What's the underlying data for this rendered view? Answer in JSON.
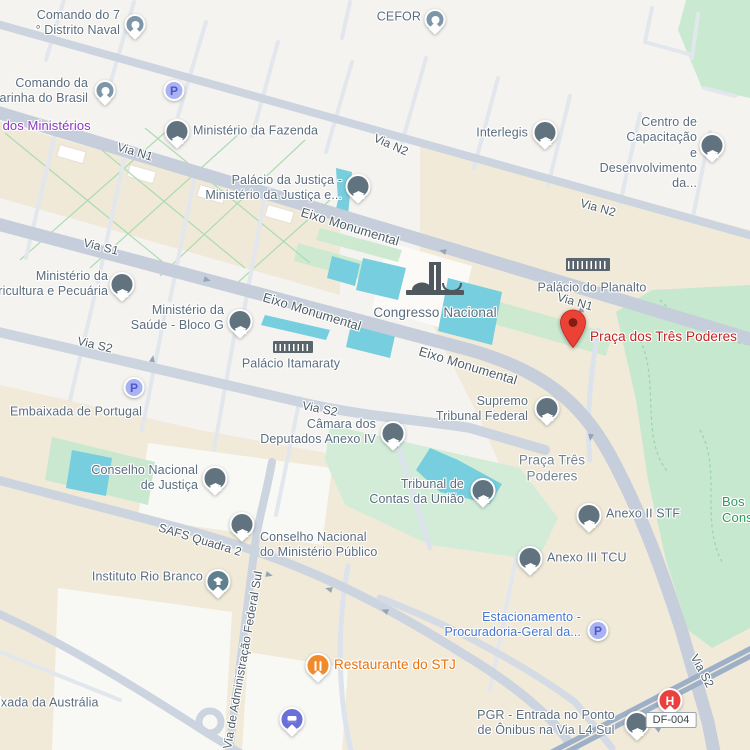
{
  "app": "google-maps-view",
  "locale_region": "Brasília, DF, Brasil",
  "labels": {
    "comando_distrito_naval": "Comando do 7\n° Distrito Naval",
    "cefor": "CEFOR",
    "comando_marinha": "Comando da\nMarinha do Brasil",
    "via_dos_ministerios": "Via dos Ministérios",
    "ministerio_fazenda": "Ministério da Fazenda",
    "via_n1": "Via N1",
    "via_n2": "Via N2",
    "interlegis": "Interlegis",
    "centro_capacitacao": "Centro de Capacitação\ne Desenvolvimento da...",
    "palacio_justica": "Palácio da Justiça -\nMinistério da Justiça e...",
    "eixo_monumental": "Eixo Monumental",
    "via_s1": "Via S1",
    "ministerio_agricultura": "Ministério da\nAgricultura e Pecuária",
    "ministerio_saude": "Ministério da\nSaúde - Bloco G",
    "palacio_itamaraty": "Palácio Itamaraty",
    "congresso_nacional": "Congresso Nacional",
    "palacio_planalto": "Palácio do Planalto",
    "praca_tres_poderes_marker": "Praça dos Três Poderes",
    "via_s2": "Via S2",
    "embaixada_portugal": "Embaixada de Portugal",
    "camara_deputados_anexo4": "Câmara dos\nDeputados Anexo IV",
    "supremo_tribunal_federal": "Supremo\nTribunal Federal",
    "praca_tres_poderes_area": "Praça Três\nPoderes",
    "conselho_nacional_justica": "Conselho Nacional\nde Justiça",
    "tribunal_contas_uniao": "Tribunal de\nContas da União",
    "bosque_truncated": "Bos\nCons",
    "anexo2_stf": "Anexo II STF",
    "conselho_ministerio_publico": "Conselho Nacional\ndo Ministério Público",
    "safs_quadra2": "SAFS Quadra 2",
    "anexo3_tcu": "Anexo III TCU",
    "instituto_rio_branco": "Instituto Rio Branco",
    "estacionamento_pgr": "Estacionamento -\nProcuradoria-Geral da...",
    "restaurante_stj": "Restaurante do STJ",
    "via_adm_federal_sul": "Via de Administração Federal Sul",
    "embaixada_australia": "Embaixada da Austrália",
    "pgr_entrada_onibus": "PGR - Entrada no Ponto\nde Ônibus na Via L4 Sul",
    "df_004": "DF-004",
    "parking_p": "P",
    "hospital_h": "H"
  },
  "colors": {
    "land_base": "#f4f3ef",
    "land_beige": "#f0e9d8",
    "park_green": "#c6e8cf",
    "water_cyan": "#76cede",
    "road_main": "#ccd3df",
    "road_minor": "#e2e7ee",
    "highway": "#9eb0c8",
    "poi_label": "#5b6d7e",
    "road_label": "#4e5c66",
    "destination_red": "#ea4335",
    "red_label": "#c5221f",
    "blue_label": "#4576d2",
    "orange_label": "#e8710a",
    "green_label": "#2f9a5d",
    "purple_label": "#8f35c4",
    "pin_institution": "#627380",
    "pin_default": "#7e97a8",
    "pin_school": "#60808d",
    "pin_parking": "#a9b3f3",
    "pin_restaurant": "#f18a2b",
    "pin_lodging": "#6a70d8",
    "pin_hospital": "#ea4040"
  }
}
